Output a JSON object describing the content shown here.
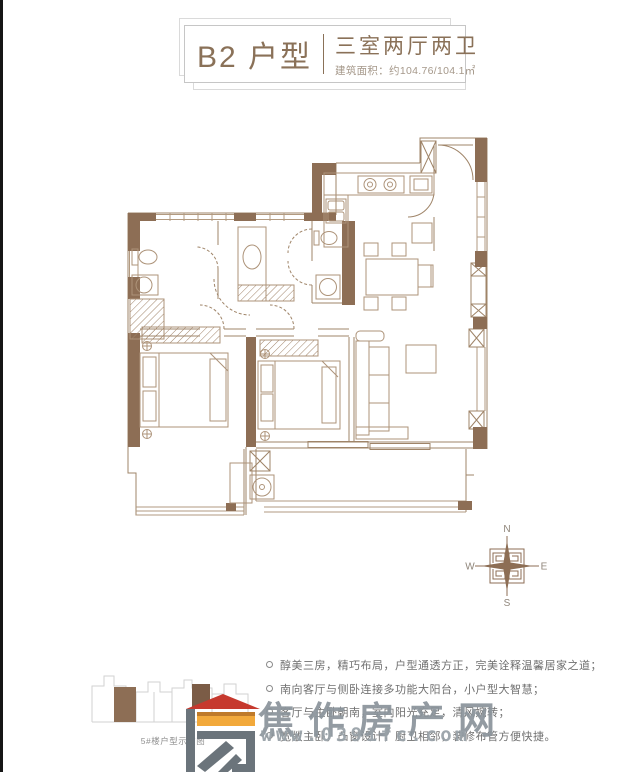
{
  "title": {
    "unit": "B2 户型",
    "rooms": "三室两厅两卫",
    "area": "建筑面积：约104.76/104.1㎡"
  },
  "features": [
    "醇美三房，精巧布局，户型通透方正，完美诠释温馨居家之道；",
    "南向客厅与侧卧连接多功能大阳台，小户型大智慧；",
    "客厅与主卧朝南，室内阳光充足，清风婉转；",
    "宽敞主卧，凸窗设计，厨卫相邻，装修布管方便快捷。"
  ],
  "building_diagram": {
    "caption": "5#楼户型示意图"
  },
  "compass": {
    "n": "N",
    "e": "E",
    "s": "S",
    "w": "W"
  },
  "watermark": {
    "name": "焦作房产网",
    "url": "www.0391fc.com"
  },
  "colors": {
    "wall_brown": "#8d6e55",
    "line_brown": "#9f8468",
    "title_text": "#8a7158",
    "logo_red": "#c6392e",
    "logo_orange": "#f2a93b",
    "logo_gray": "#6b747b",
    "watermark_text": "#8b949b"
  }
}
